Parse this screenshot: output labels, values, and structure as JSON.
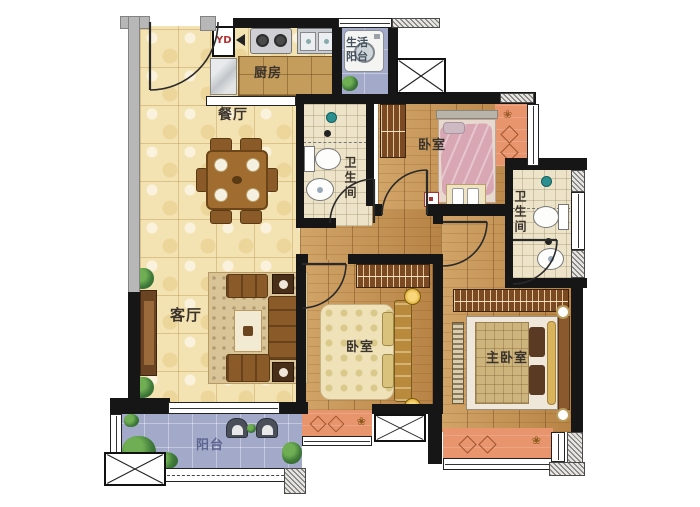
{
  "plan_title": "three-bedroom apartment floor plan",
  "rooms": {
    "kitchen": "厨房",
    "dining": "餐厅",
    "living": "客厅",
    "balcony": "阳台",
    "utility_balcony": "生活阳台",
    "bedroom_top": "卧室",
    "bedroom_middle": "卧室",
    "master_bedroom": "主卧室",
    "bathroom_middle": "卫生间",
    "bathroom_right": "卫生间",
    "duct": "YD"
  },
  "colors": {
    "tile": "#f3e3b2",
    "wood": "#c28e4e",
    "bath": "#ece3c8",
    "balcony": "#a2a9c9",
    "bay_window": "#e8956e",
    "wall": "#161616",
    "wall_light": "#b7b7b7",
    "duct_text": "#b03030",
    "balcony_text": "#5d6590",
    "utility_text": "#44525e"
  }
}
